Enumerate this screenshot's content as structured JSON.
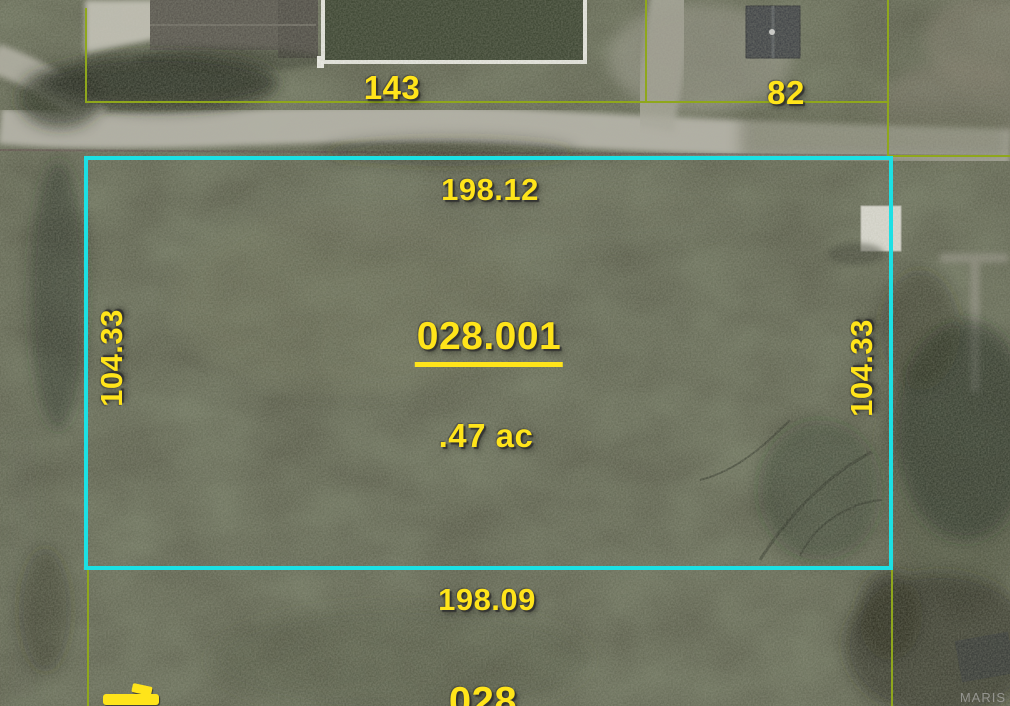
{
  "map": {
    "watermark": "MARIS",
    "colors": {
      "highlight_boundary": "#1CE0E4",
      "parcel_boundary": "#8FA71C",
      "label_text": "#FFE41A",
      "watermark_text": "#A0A09C"
    },
    "subject_parcel": {
      "id": "028.001",
      "area": ".47 ac",
      "frontage_top": "198.12",
      "frontage_bottom": "198.09",
      "side_left": "104.33",
      "side_right": "104.33"
    },
    "adjacent_parcels": {
      "northwest_lot_width": "143",
      "northeast_lot_width": "82",
      "south_parcel_id": "028"
    }
  }
}
